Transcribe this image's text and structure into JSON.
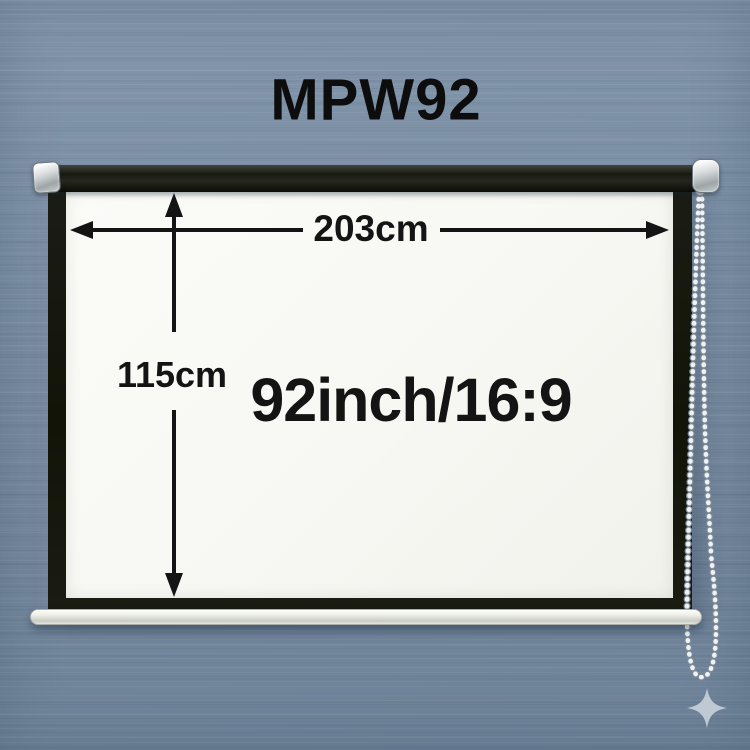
{
  "product": {
    "model": "MPW92",
    "screen_size": "92inch/16:9",
    "width": "203cm",
    "height": "115cm"
  },
  "colors": {
    "wall_background": "#74889c",
    "screen_surface": "#f7f7f3",
    "frame_and_roller": "#15170e",
    "end_caps": "#d9dcdd",
    "weight_bar": "#eceee6",
    "pull_chain": "#eef1f4",
    "annotation_text": "#141414",
    "sparkle": "#c6cfd8"
  },
  "icons": {
    "sparkle_icon": "four-pointed-star",
    "pull_chain_icon": "beaded-chain-loop",
    "width_arrow_icon": "double-headed-horizontal-arrow",
    "height_arrow_icon": "double-headed-vertical-arrow"
  }
}
